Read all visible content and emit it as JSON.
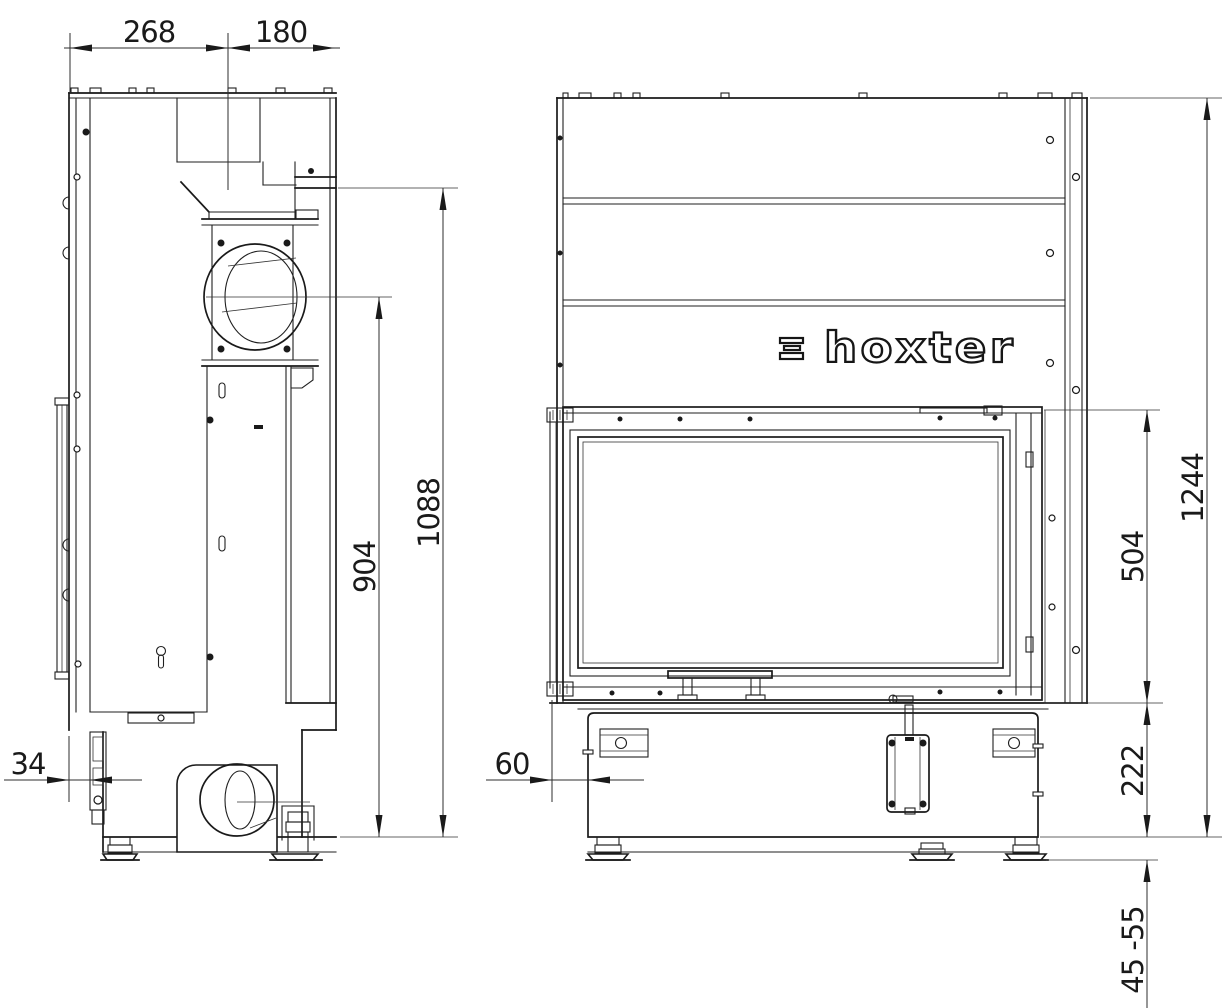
{
  "logo": {
    "text": "hoxter"
  },
  "dimensions": {
    "top_rear_width": "268",
    "top_front_width": "180",
    "flue_center_height": "904",
    "top_edge_height": "1088",
    "rear_offset": "34",
    "front_offset": "60",
    "total_height": "1244",
    "door_height": "504",
    "base_height": "222",
    "leveling_feet_range": "45 -55"
  }
}
